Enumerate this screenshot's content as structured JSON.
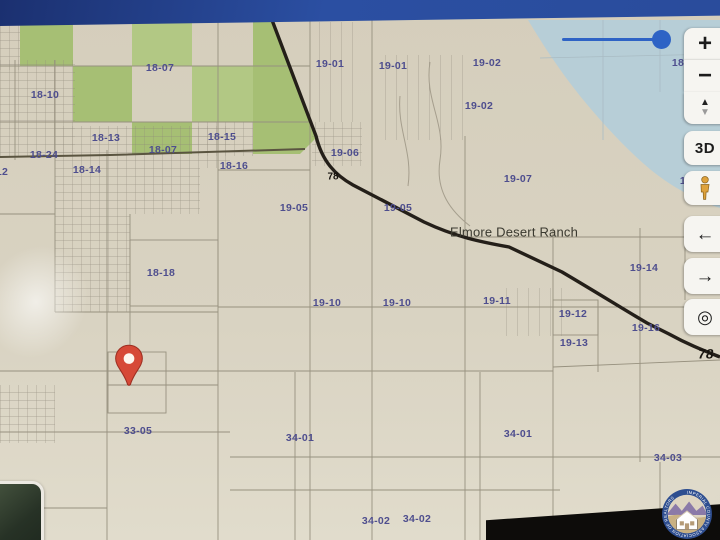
{
  "map": {
    "labels": [
      {
        "text": "18-07",
        "x": 160,
        "y": 68
      },
      {
        "text": "18-10",
        "x": 45,
        "y": 95
      },
      {
        "text": "18-13",
        "x": 106,
        "y": 138
      },
      {
        "text": "18-15",
        "x": 222,
        "y": 137
      },
      {
        "text": "18-07",
        "x": 163,
        "y": 150
      },
      {
        "text": "18-24",
        "x": 44,
        "y": 155
      },
      {
        "text": "18-14",
        "x": 87,
        "y": 170
      },
      {
        "text": "18-16",
        "x": 234,
        "y": 166
      },
      {
        "text": "18-12",
        "x": -6,
        "y": 172
      },
      {
        "text": "19-01",
        "x": 330,
        "y": 64
      },
      {
        "text": "19-01",
        "x": 393,
        "y": 66
      },
      {
        "text": "19-02",
        "x": 487,
        "y": 63
      },
      {
        "text": "19-02",
        "x": 479,
        "y": 106
      },
      {
        "text": "19-06",
        "x": 345,
        "y": 153
      },
      {
        "text": "19-07",
        "x": 518,
        "y": 179
      },
      {
        "text": "18",
        "x": 678,
        "y": 63
      },
      {
        "text": "19",
        "x": 686,
        "y": 181
      },
      {
        "text": "19-05",
        "x": 294,
        "y": 208
      },
      {
        "text": "19-05",
        "x": 398,
        "y": 208
      },
      {
        "text": "18-18",
        "x": 161,
        "y": 273
      },
      {
        "text": "19-10",
        "x": 327,
        "y": 303
      },
      {
        "text": "19-10",
        "x": 397,
        "y": 303
      },
      {
        "text": "19-11",
        "x": 497,
        "y": 301
      },
      {
        "text": "19-14",
        "x": 644,
        "y": 268
      },
      {
        "text": "19-12",
        "x": 573,
        "y": 314
      },
      {
        "text": "19-16",
        "x": 646,
        "y": 328
      },
      {
        "text": "19-13",
        "x": 574,
        "y": 343
      },
      {
        "text": "33-05",
        "x": 138,
        "y": 431
      },
      {
        "text": "34-01",
        "x": 300,
        "y": 438
      },
      {
        "text": "34-01",
        "x": 518,
        "y": 434
      },
      {
        "text": "34-03",
        "x": 668,
        "y": 458
      },
      {
        "text": "34-02",
        "x": 376,
        "y": 521
      },
      {
        "text": "34-02",
        "x": 417,
        "y": 519
      },
      {
        "text": "Elmore Desert Ranch",
        "x": 514,
        "y": 232,
        "cls": "place"
      },
      {
        "text": "78",
        "x": 333,
        "y": 177,
        "cls": "road-sm"
      },
      {
        "text": "78",
        "x": 706,
        "y": 354,
        "cls": "road-lg"
      }
    ]
  },
  "controls": {
    "buttons": [
      {
        "name": "zoom-in",
        "glyph": "+"
      },
      {
        "name": "zoom-out",
        "glyph": "−"
      },
      {
        "name": "tilt",
        "icon": "tilt",
        "up": "▲",
        "down": "▼"
      },
      {
        "name": "3d-view",
        "glyph": "3D"
      },
      {
        "name": "street-view",
        "icon": "pegman"
      },
      {
        "name": "pan-left",
        "glyph": "←"
      },
      {
        "name": "pan-right",
        "glyph": "→"
      },
      {
        "name": "locate",
        "glyph": "◎"
      }
    ]
  },
  "slider": {
    "orientation": "horizontal",
    "handle_at": "right"
  },
  "marker": {
    "type": "red-pin"
  },
  "logo": {
    "ring_text": "IMPERIAL COUNTY ASSOCIATION OF REALTORS"
  },
  "colors": {
    "land": "#d7d0bf",
    "land_light": "#e0dbcb",
    "water": "#b7ced7",
    "green": "#a6bf74",
    "green2": "#b2c884",
    "line": "#97917f",
    "road": "#241f19",
    "label": "#4e4e8e",
    "place": "#3a392f",
    "accent": "#2e63c5",
    "pin": "#d64937",
    "pegman": "#dfa23c",
    "bezel": "#2a4c9c"
  }
}
